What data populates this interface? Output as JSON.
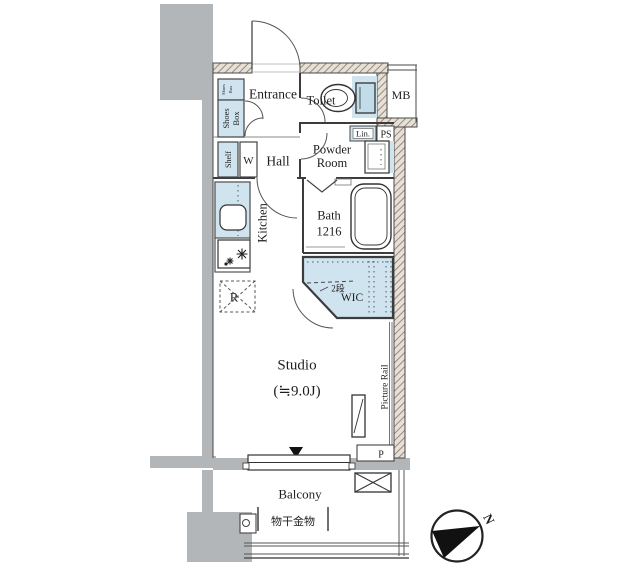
{
  "plan": {
    "type": "floor-plan",
    "unit_name": "Studio",
    "unit_size": "(≒9.0J)"
  },
  "colors": {
    "wall_hatch_line": "#8d8173",
    "wall_hatch_bg": "#e6e0d7",
    "concrete_gray": "#b3b6b8",
    "fixture_blue": "#cfe4ef",
    "line": "#444444"
  },
  "labels": {
    "entrance": "Entrance",
    "toilet": "Toilet",
    "mb": "MB",
    "ps": "PS",
    "lin": "Lin.",
    "powder1": "Powder",
    "powder2": "Room",
    "hall": "Hall",
    "washer": "W",
    "shelf": "Shelf",
    "shoes_upper1": "Shoes",
    "shoes_upper2": "Box",
    "shoes1": "Shoes",
    "shoes2": "Box",
    "kitchen": "Kitchen",
    "bath1": "Bath",
    "bath2": "1216",
    "wic": "WIC",
    "wic_note": "2段",
    "fridge": "R",
    "studio": "Studio",
    "studio_size": "(≒9.0J)",
    "picture_rail": "Picture Rail",
    "pillar": "P",
    "balcony": "Balcony",
    "laundry": "物干金物",
    "north": "N"
  }
}
